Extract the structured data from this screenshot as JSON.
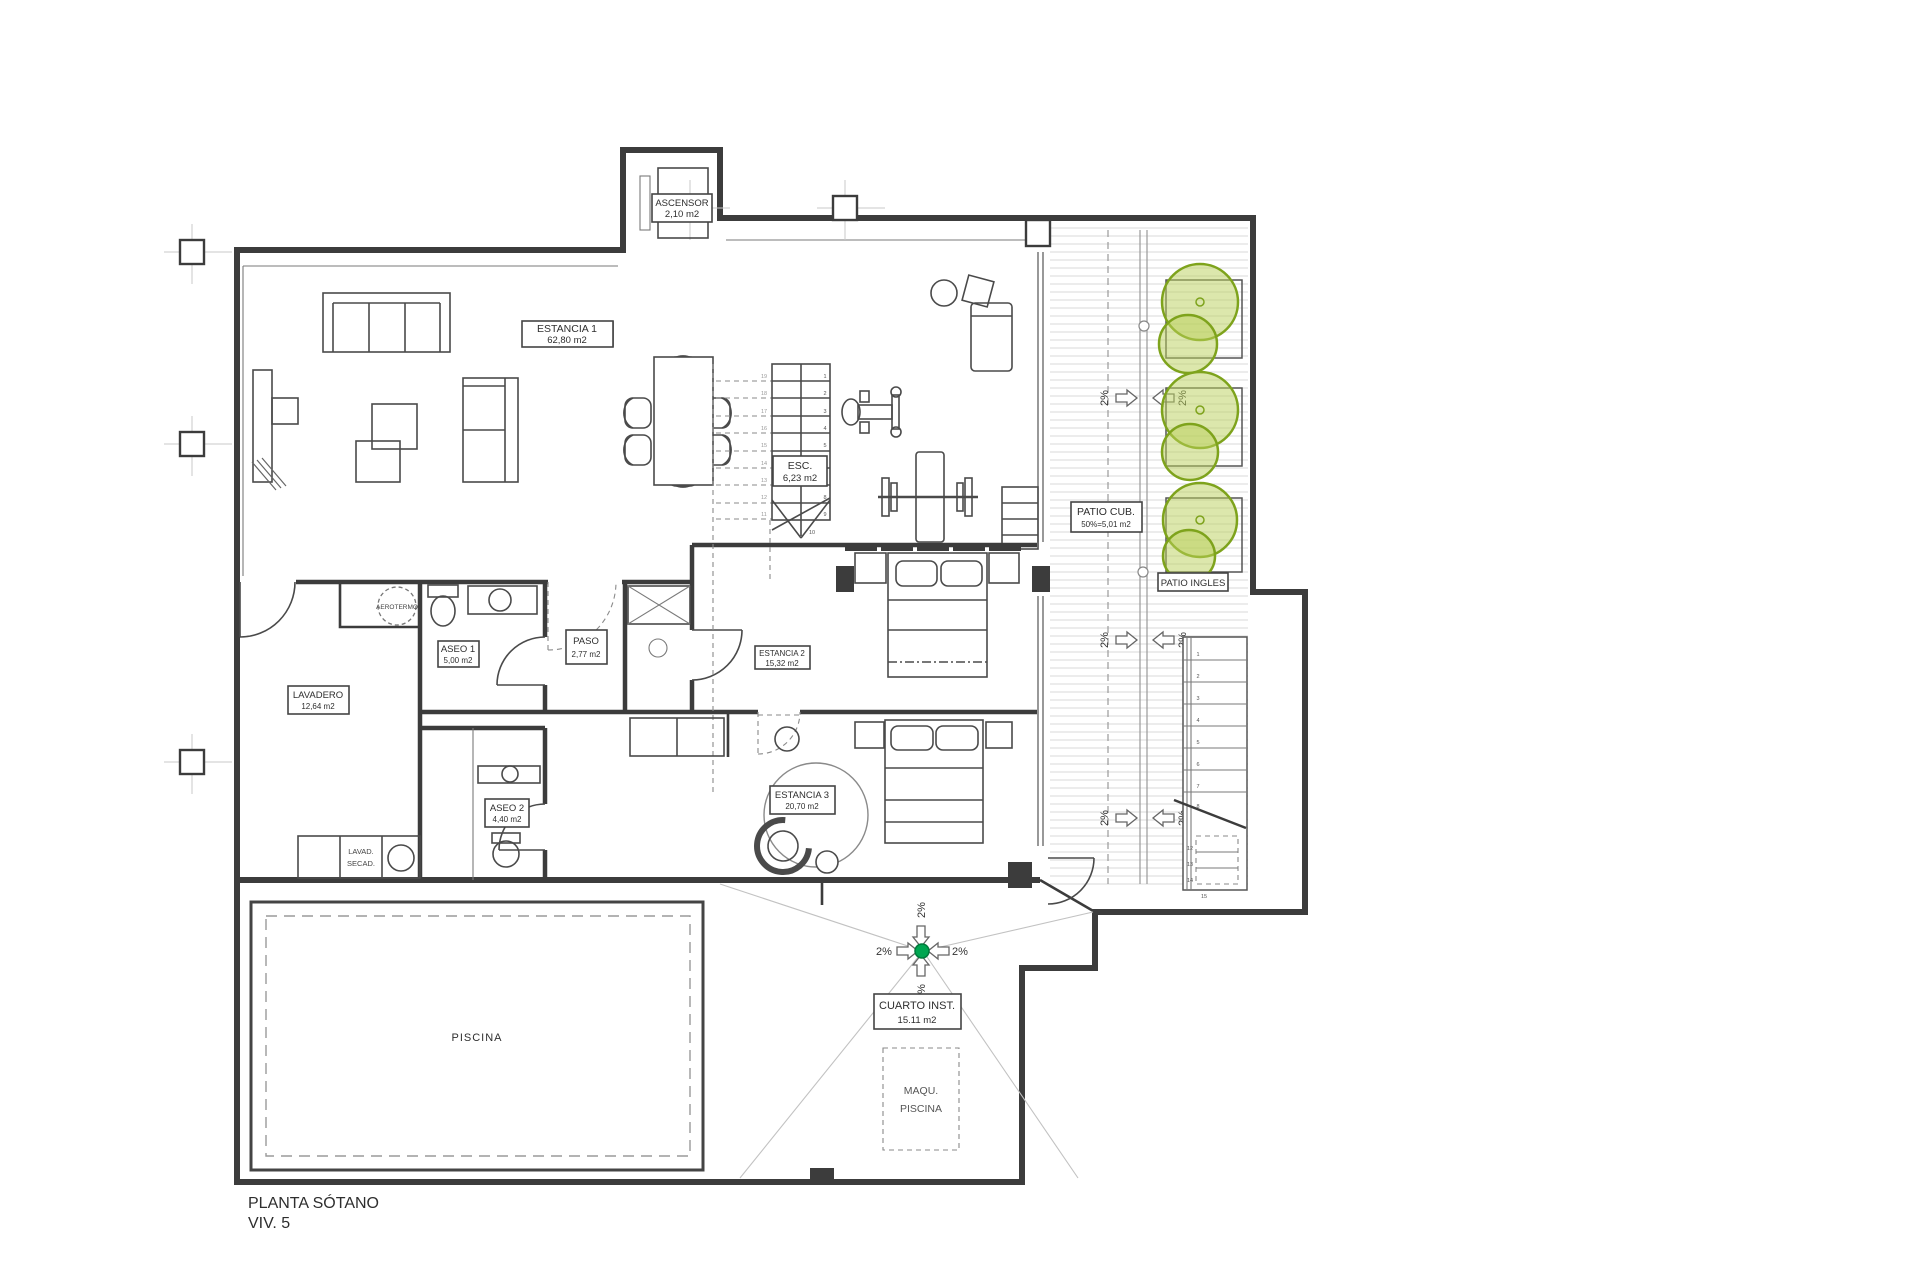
{
  "title": {
    "line1": "PLANTA SÓTANO",
    "line2": "VIV. 5"
  },
  "rooms": {
    "ascensor": {
      "name": "ASCENSOR",
      "area": "2,10 m2"
    },
    "estancia1": {
      "name": "ESTANCIA 1",
      "area": "62,80 m2"
    },
    "esc": {
      "name": "ESC.",
      "area": "6,23 m2"
    },
    "patio_cub": {
      "name": "PATIO CUB.",
      "area": "50%=5,01 m2"
    },
    "patio_ingles": {
      "name": "PATIO INGLES"
    },
    "aseo1": {
      "name": "ASEO 1",
      "area": "5,00 m2"
    },
    "paso": {
      "name": "PASO",
      "area": "2,77 m2"
    },
    "estancia2": {
      "name": "ESTANCIA 2",
      "area": "15,32 m2"
    },
    "lavadero": {
      "name": "LAVADERO",
      "area": "12,64 m2"
    },
    "aseo2": {
      "name": "ASEO 2",
      "area": "4,40 m2"
    },
    "estancia3": {
      "name": "ESTANCIA 3",
      "area": "20,70 m2"
    },
    "cuarto_inst": {
      "name": "CUARTO INST.",
      "area": "15.11 m2"
    },
    "piscina": {
      "name": "PISCINA"
    },
    "maqu_piscina": {
      "line1": "MAQU.",
      "line2": "PISCINA"
    },
    "aerotermo": {
      "name": "AEROTERMO"
    },
    "lavad_secad": {
      "line1": "LAVAD.",
      "line2": "SECAD."
    }
  },
  "annotations": {
    "slope": "2%"
  },
  "stairs": {
    "main_down": [
      "1",
      "2",
      "3",
      "4",
      "5",
      "6",
      "7",
      "8",
      "9",
      "10"
    ],
    "main_up": [
      "11",
      "12",
      "13",
      "14",
      "15",
      "16",
      "17",
      "18",
      "19"
    ],
    "patio": [
      "1",
      "2",
      "3",
      "4",
      "5",
      "6",
      "7",
      "8",
      "12",
      "13",
      "14",
      "15"
    ]
  },
  "colors": {
    "wall": "#3c3c3c",
    "deck_line": "#dcdcdc",
    "tree_stroke": "#7ea31c",
    "tree_fill": "#b9d05a",
    "drain_green": "#00a651"
  }
}
